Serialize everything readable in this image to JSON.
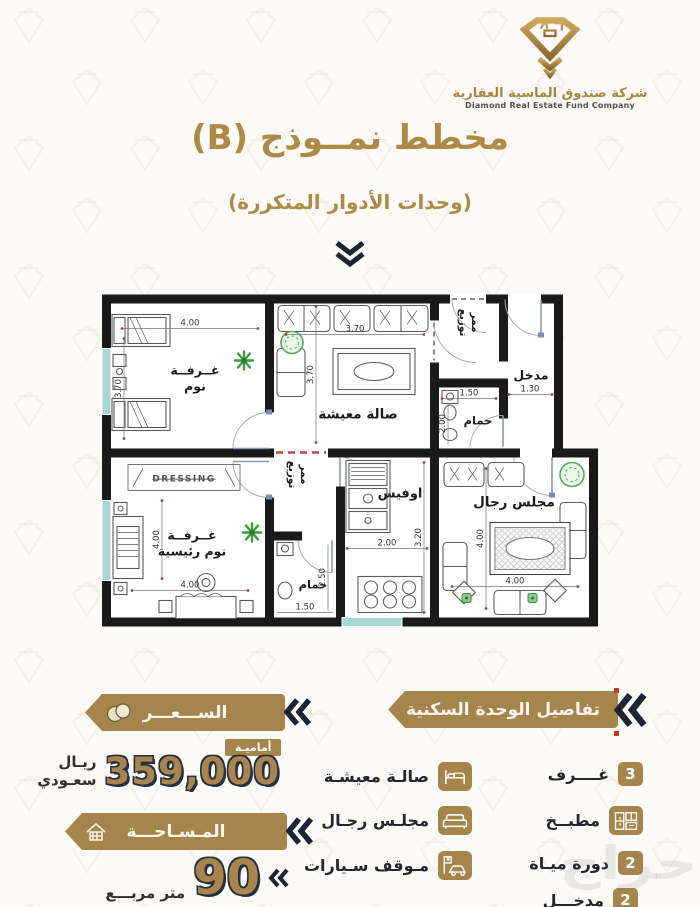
{
  "header": {
    "company_name_ar": "شركة صندوق الماسية العقارية",
    "company_name_en": "Diamond Real Estate Fund Company"
  },
  "title": {
    "main": "مخطط نمــوذج (B)",
    "subtitle": "(وحدات الأدوار المتكررة)"
  },
  "plan": {
    "bedroom": {
      "line1": "غــرفــة",
      "line2": "نوم",
      "w": "4.00",
      "h": "3.70"
    },
    "living": {
      "label": "صالة معيشة",
      "w": "3.70",
      "h": "3.70"
    },
    "corridor_top": {
      "line1": "ممر",
      "line2": "توزيع"
    },
    "entry": {
      "label": "مدخل",
      "w": "1.30"
    },
    "bath_top": {
      "label": "حمام",
      "w": "1.50",
      "h": "2.00"
    },
    "corridor_mid": {
      "line1": "ممر",
      "line2": "توزيع"
    },
    "office": {
      "label": "اوفيس",
      "w": "2.00",
      "h": "3.20"
    },
    "bath_bottom": {
      "label": "حمام",
      "w": "1.50",
      "h": "2.50"
    },
    "master": {
      "line1": "غــرفــة",
      "line2": "نوم رئيسية",
      "w": "4.00",
      "h": "4.00"
    },
    "majlis": {
      "label": "مجلس رجال",
      "w": "4.00",
      "h": "4.00"
    },
    "dressing": "DRESSING"
  },
  "details": {
    "title": "تفاصيل الوحدة السكنية",
    "rooms_count": "3",
    "rooms_label": "غــــرف",
    "kitchen_label": "مطبــخ",
    "wc_count": "2",
    "wc_label": "دورة ميـاة",
    "entrance_count": "2",
    "entrance_label": "مدخـــل",
    "living_label": "صالـة معيشـة",
    "majlis_label": "مجلـس رجـال",
    "parking_label": "مـوقف سـيارات"
  },
  "price": {
    "banner": "الســـعـــر",
    "badge": "أماميـة",
    "value": "359,000",
    "currency": "ريـال سعـودي"
  },
  "area": {
    "banner": "المـسـاحـــة",
    "value": "90",
    "unit": "متر مربـــع"
  },
  "watermark": "حراج",
  "colors": {
    "gold": "#a6854d",
    "gold_text": "#ae8a47",
    "dark_navy": "#1d2433",
    "window_teal": "#a8d8d2",
    "plant_green": "#4a9e4a",
    "red_accent": "#c0392b"
  }
}
